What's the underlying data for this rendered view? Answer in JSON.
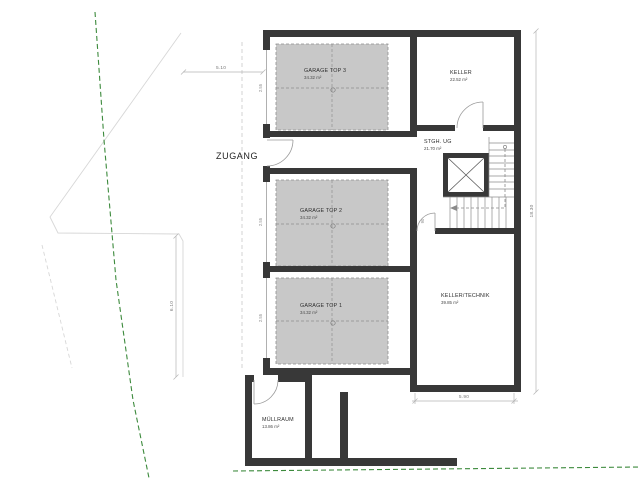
{
  "plan": {
    "entrance_label": "ZUGANG",
    "type": "basement-floor-plan"
  },
  "rooms": {
    "garage3": {
      "name": "GARAGE TOP 3",
      "area": "34.32 m²"
    },
    "garage2": {
      "name": "GARAGE TOP 2",
      "area": "34.32 m²"
    },
    "garage1": {
      "name": "GARAGE TOP 1",
      "area": "34.32 m²"
    },
    "keller": {
      "name": "KELLER",
      "area": "22.52 m²"
    },
    "stgh": {
      "name": "STGH. UG",
      "area": "21.70 m²"
    },
    "technik": {
      "name": "KELLER/TECHNIK",
      "area": "39.85 m²"
    },
    "muell": {
      "name": "MÜLLRAUM",
      "area": "13.86 m²"
    }
  },
  "dimensions": {
    "top": "5.10",
    "left": "6.10",
    "right": "18.30",
    "bottom": "5.90",
    "garage_door": "2.55",
    "stair_door": "90"
  },
  "colors": {
    "wall": "#383838",
    "garage_fill": "#c8c8c8",
    "boundary_green": "#3c8a3c",
    "paper": "#ffffff"
  }
}
